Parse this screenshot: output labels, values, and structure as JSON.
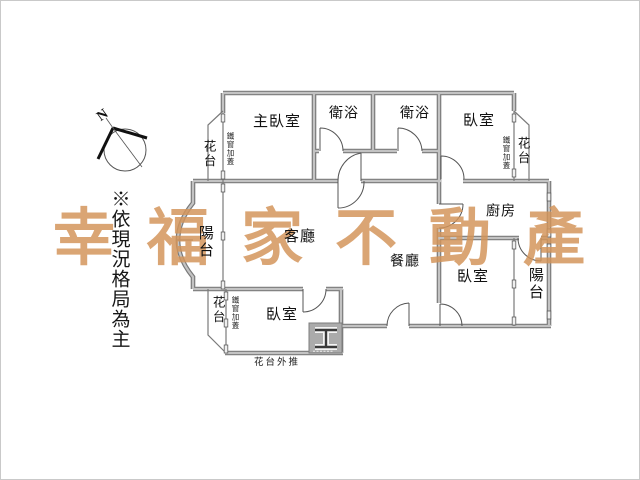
{
  "watermark": {
    "text": "幸福家不動產"
  },
  "compass": {
    "label": "N"
  },
  "note": {
    "text": "※依現況格局為主"
  },
  "labels": {
    "master_bedroom": "主臥室",
    "bathroom_1": "衛浴",
    "bathroom_2": "衛浴",
    "bedroom_top_right": "臥室",
    "kitchen": "廚房",
    "living_room": "客廳",
    "dining_room": "餐廳",
    "bedroom_bottom_left": "臥室",
    "bedroom_bottom_right": "臥室",
    "balcony_left": "陽台",
    "balcony_bottom_right": "陽台",
    "flower_bed_top_left": "花台",
    "flower_bed_top_right": "花台",
    "flower_bed_bottom_left": "花台",
    "iron_window_top_left": "鐵窗加蓋",
    "iron_window_top_right": "鐵窗加蓋",
    "iron_window_bottom_left": "鐵窗加蓋",
    "flower_bed_note": "花台外推"
  },
  "colors": {
    "wall_edge": "#7a7a7a",
    "wall_fill": "#c3c3c3",
    "door_line": "#555555",
    "text": "#111111",
    "watermark": "#d4955a"
  }
}
